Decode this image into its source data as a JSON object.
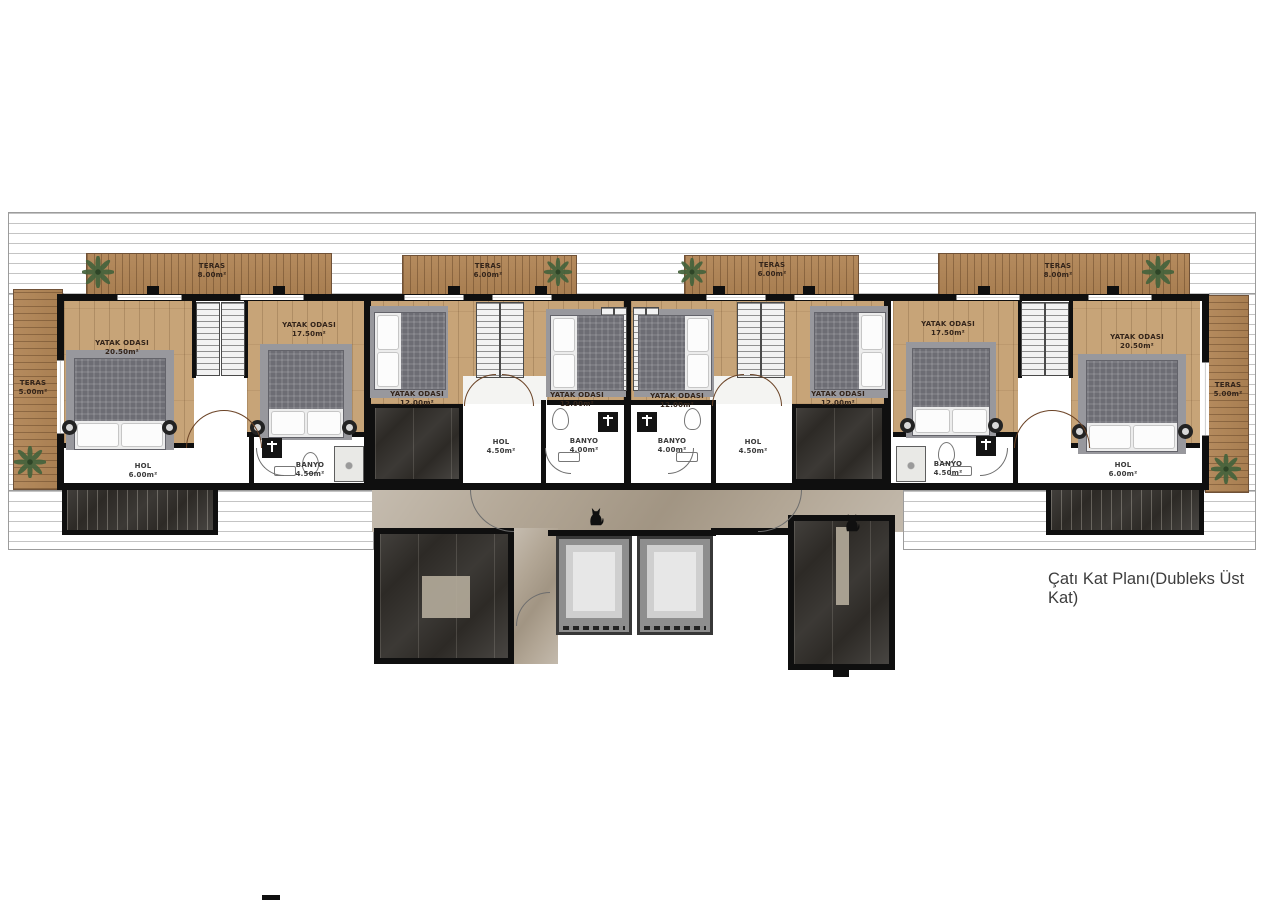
{
  "caption": "Çatı Kat Planı(Dubleks Üst Kat)",
  "labels": {
    "teras_a": {
      "name": "TERAS",
      "area": "8.00m²"
    },
    "teras_b": {
      "name": "TERAS",
      "area": "6.00m²"
    },
    "teras_c": {
      "name": "TERAS",
      "area": "6.00m²"
    },
    "teras_d": {
      "name": "TERAS",
      "area": "8.00m²"
    },
    "teras_left": {
      "name": "TERAS",
      "area": "5.00m²"
    },
    "teras_right": {
      "name": "TERAS",
      "area": "5.00m²"
    },
    "a1": {
      "name": "YATAK ODASI",
      "area": "20.50m²"
    },
    "a2": {
      "name": "YATAK ODASI",
      "area": "17.50m²"
    },
    "a_hol": {
      "name": "HOL",
      "area": "6.00m²"
    },
    "a_banyo": {
      "name": "BANYO",
      "area": "4.50m²"
    },
    "b1": {
      "name": "YATAK ODASI",
      "area": "12.00m²"
    },
    "b2": {
      "name": "YATAK ODASI",
      "area": "12.00m²"
    },
    "b_hol": {
      "name": "HOL",
      "area": "4.50m²"
    },
    "b_banyo": {
      "name": "BANYO",
      "area": "4.00m²"
    },
    "c1": {
      "name": "YATAK ODASI",
      "area": "12.00m²"
    },
    "c2": {
      "name": "YATAK ODASI",
      "area": "12.00m²"
    },
    "c_hol": {
      "name": "HOL",
      "area": "4.50m²"
    },
    "c_banyo": {
      "name": "BANYO",
      "area": "4.00m²"
    },
    "d1": {
      "name": "YATAK ODASI",
      "area": "17.50m²"
    },
    "d2": {
      "name": "YATAK ODASI",
      "area": "20.50m²"
    },
    "d_hol": {
      "name": "HOL",
      "area": "6.00m²"
    },
    "d_banyo": {
      "name": "BANYO",
      "area": "4.50m²"
    }
  },
  "colors": {
    "wall": "#0f0f0f",
    "bedroom_wood": "#c7a478",
    "terrace_wood": "#ab8257",
    "dark_marble": "#2d2a26",
    "light_marble": "#b2a695",
    "plant_green": "#45633c"
  }
}
